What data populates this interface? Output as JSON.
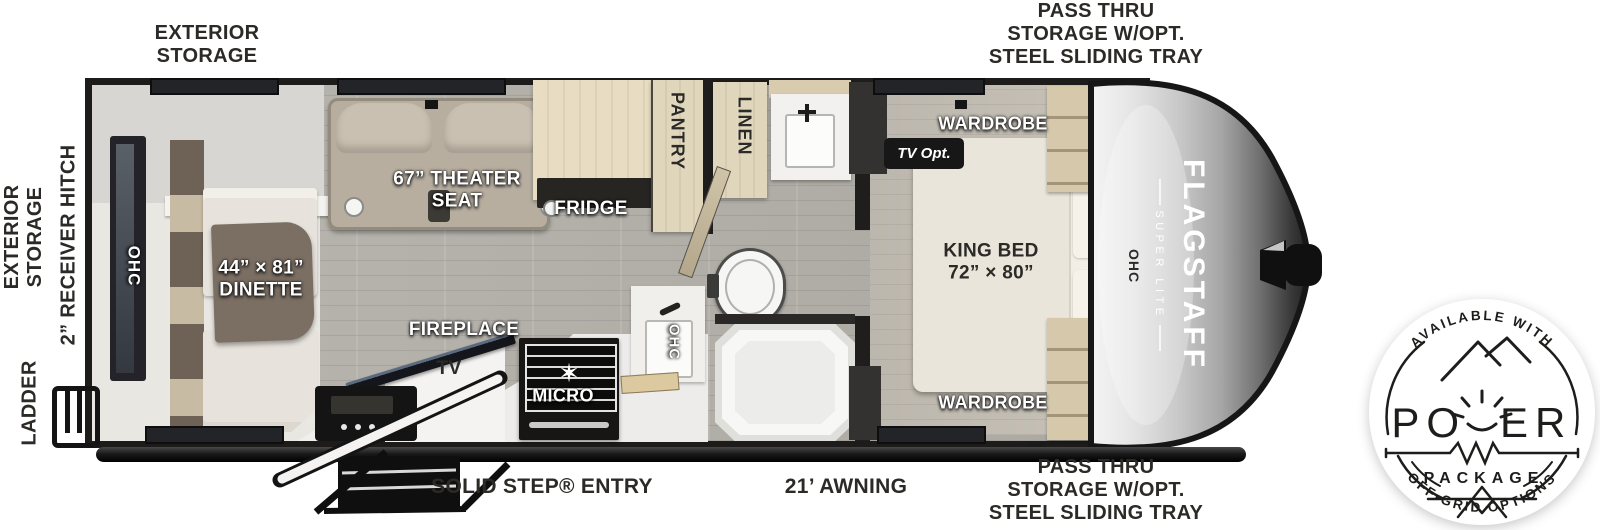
{
  "labels": {
    "exterior_storage_top_1": "EXTERIOR",
    "exterior_storage_top_2": "STORAGE",
    "pass_thru_top_1": "PASS THRU",
    "pass_thru_top_2": "STORAGE W/OPT.",
    "pass_thru_top_3": "STEEL SLIDING TRAY",
    "exterior_storage_side_1": "EXTERIOR",
    "exterior_storage_side_2": "STORAGE",
    "receiver_hitch": "2” RECEIVER HITCH",
    "ladder": "LADDER",
    "solid_step_entry": "SOLID STEP® ENTRY",
    "awning": "21’ AWNING",
    "pass_thru_bottom_1": "PASS THRU",
    "pass_thru_bottom_2": "STORAGE W/OPT.",
    "pass_thru_bottom_3": "STEEL SLIDING TRAY"
  },
  "rooms": {
    "ohc_rear": "OHC",
    "dinette_size": "44” × 81”",
    "dinette": "DINETTE",
    "theater_1": "67” THEATER",
    "theater_2": "SEAT",
    "fridge": "FRIDGE",
    "pantry": "PANTRY",
    "linen": "LINEN",
    "fireplace": "FIREPLACE",
    "tv": "TV",
    "micro": "MICRO",
    "ohc_kitchen": "OHC",
    "wardrobe_top": "WARDROBE",
    "tv_opt": "TV Opt.",
    "king_bed_1": "KING BED",
    "king_bed_2": "72” × 80”",
    "ohc_bedroom": "OHC",
    "wardrobe_bottom": "WARDROBE"
  },
  "brand": {
    "name": "FLAGSTAFF",
    "sub": "SUPER LITE"
  },
  "badge": {
    "arc_top": "AVAILABLE WITH",
    "power_left": "PO",
    "power_right": "ER",
    "package": "PACKAGE",
    "arc_bottom": "OFF-GRID OPTIONS"
  },
  "colors": {
    "wall": "#201f1d",
    "floor_wood": "#b3b0aa",
    "cabinet_wood": "#e2d8bf",
    "upholstery": "#e7e3dc",
    "counter_white": "#efeeeb",
    "table_brown": "#7b6f64",
    "label_ink": "#2b2a27",
    "badge_ink": "#1d1d1b"
  }
}
